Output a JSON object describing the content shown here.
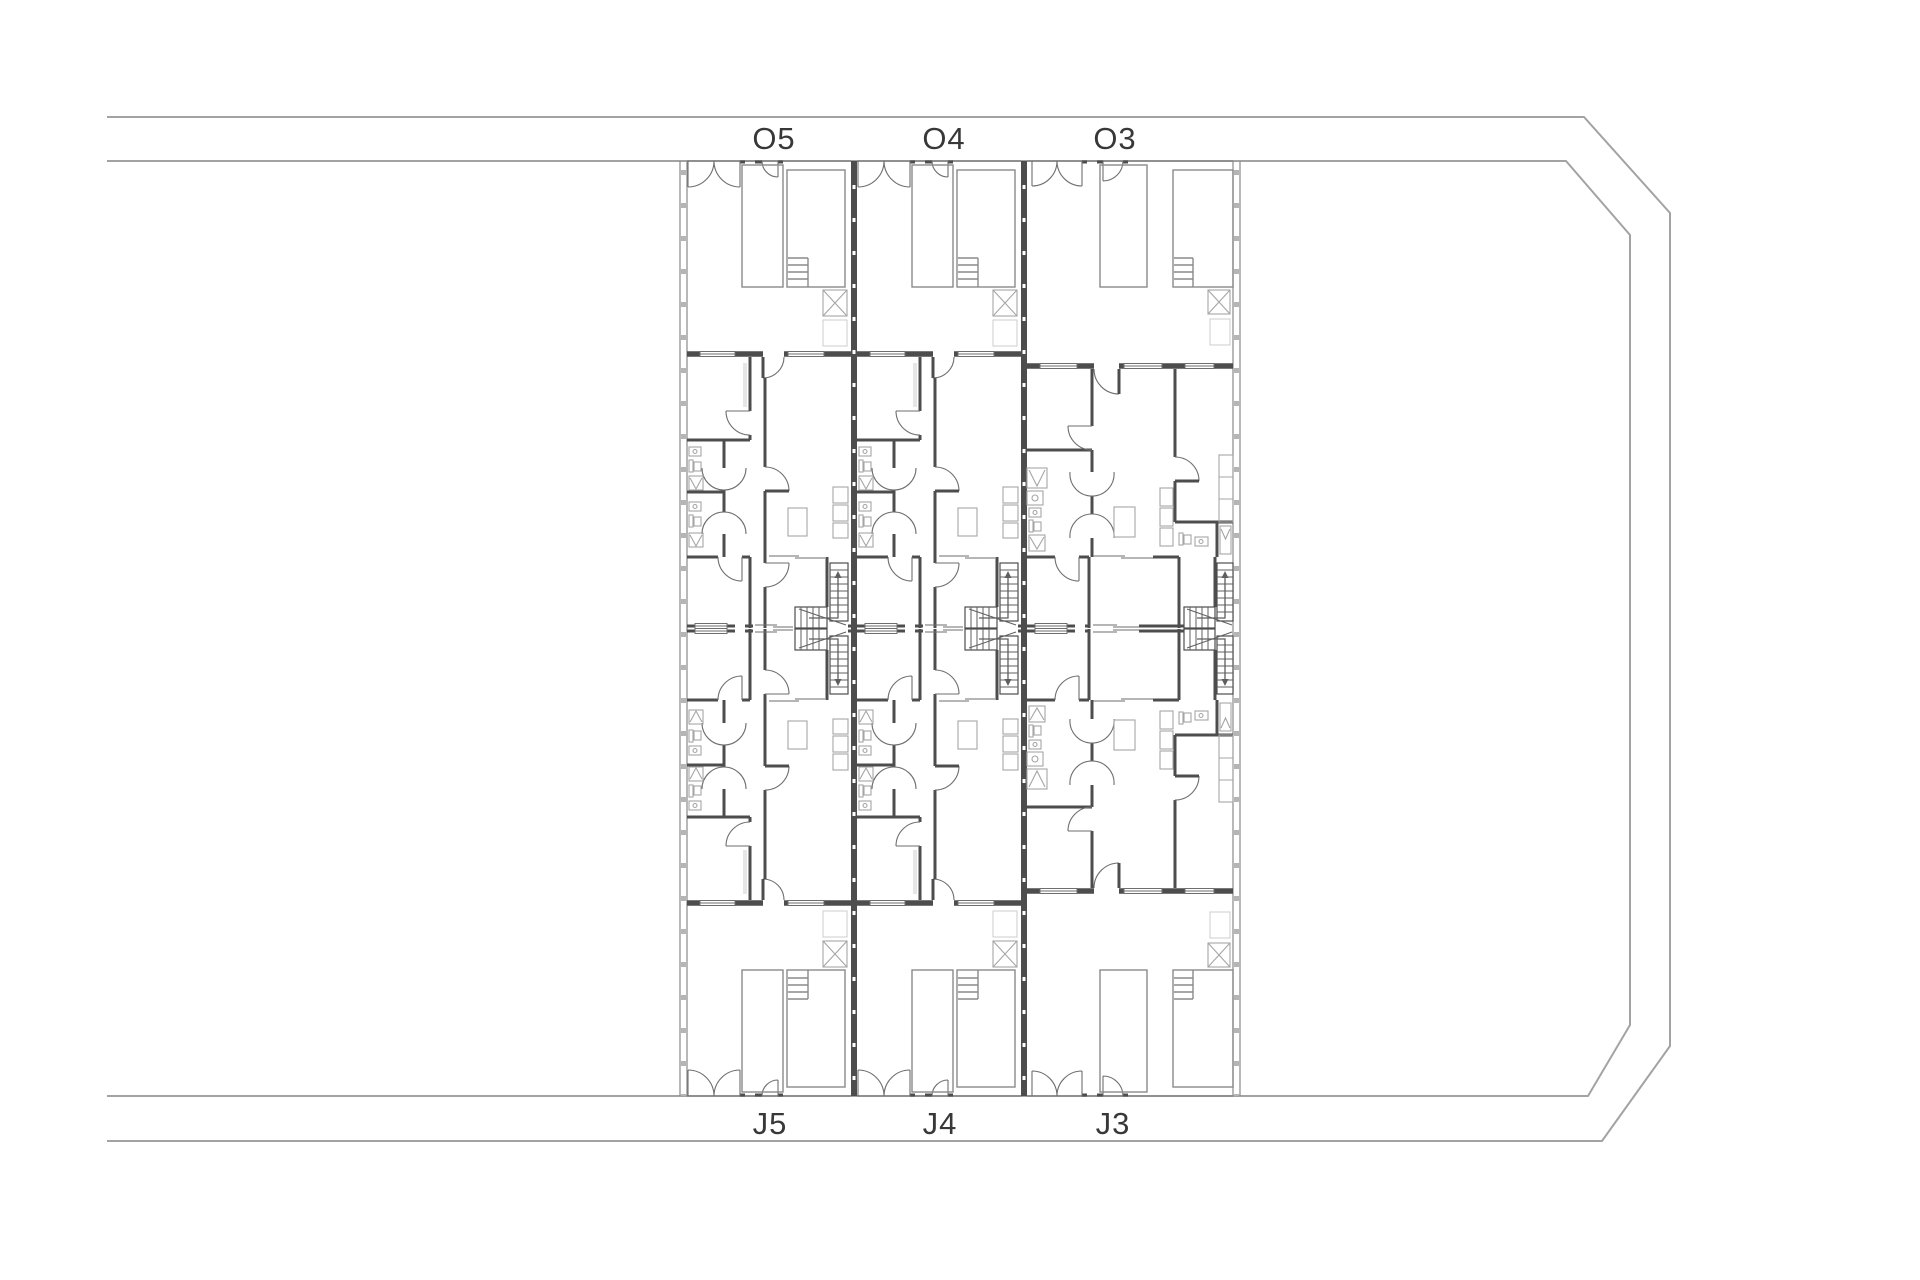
{
  "site": {
    "unit_labels_top": [
      {
        "id": "O5"
      },
      {
        "id": "O4"
      },
      {
        "id": "O3"
      }
    ],
    "unit_labels_bottom": [
      {
        "id": "J5"
      },
      {
        "id": "J4"
      },
      {
        "id": "J3"
      }
    ]
  },
  "colors": {
    "background": "#ffffff",
    "boundary": "#a3a3a3",
    "wall": "#4d4d4d",
    "interior_line": "#6e6e6e",
    "yard_line": "#8a8a8a",
    "fixture": "#a5a5a5",
    "faint": "#cccccc",
    "tread": "#5f5f5f",
    "label_text": "#383838"
  }
}
